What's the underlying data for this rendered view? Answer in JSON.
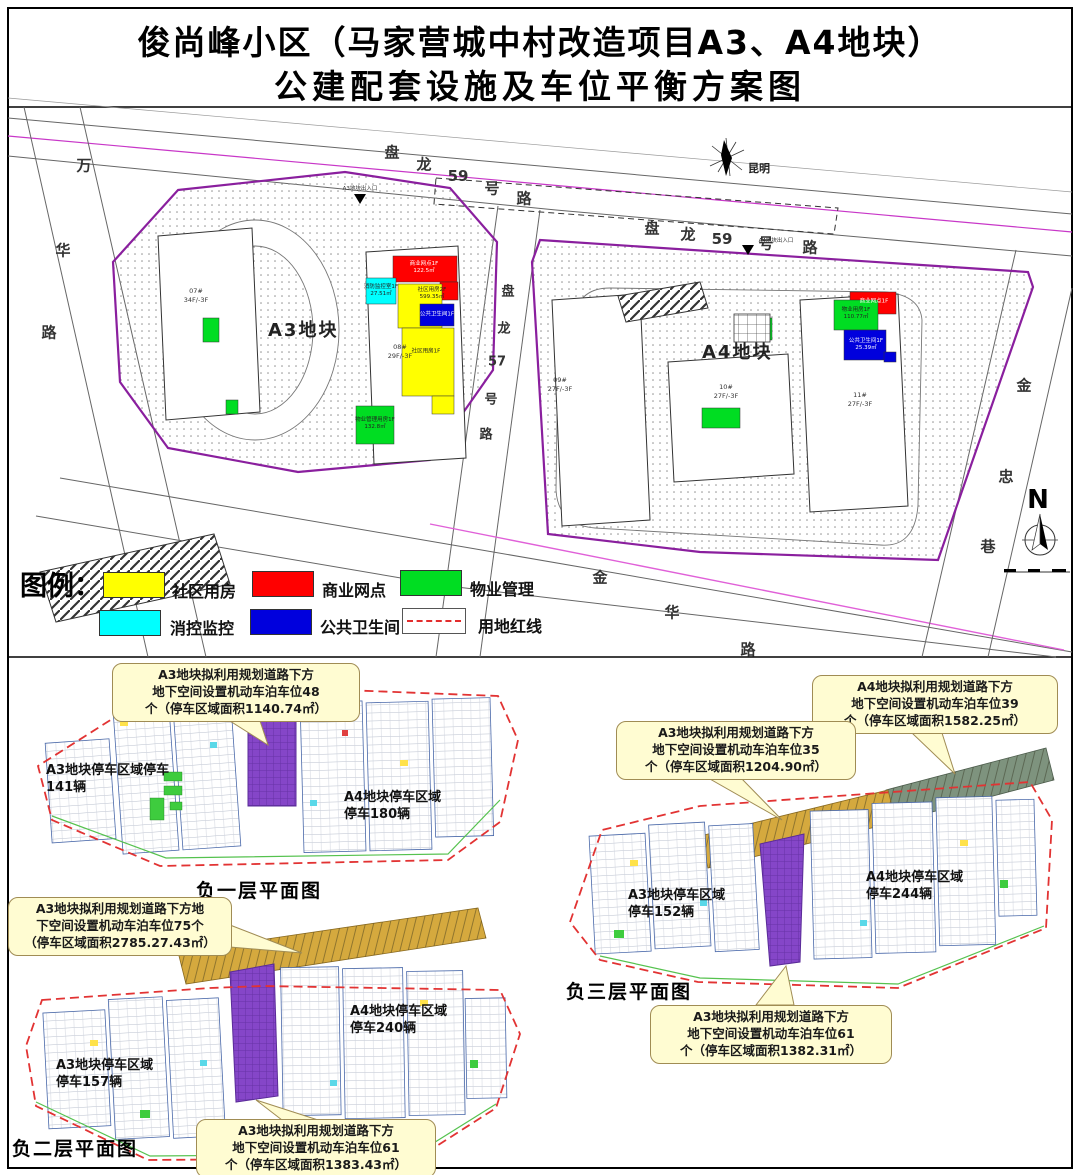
{
  "title": {
    "line1": "俊尚峰小区（马家营城中村改造项目A3、A4地块）",
    "line2": "公建配套设施及车位平衡方案图"
  },
  "site": {
    "plot_a3": "A3地块",
    "plot_a4": "A4地块",
    "city_label": "昆明",
    "north": "N",
    "roads": {
      "panlong59a": [
        "盘",
        "龙",
        "59",
        "号",
        "路"
      ],
      "panlong59b": [
        "盘",
        "龙",
        "59",
        "号",
        "路"
      ],
      "wanhua": [
        "万",
        "华",
        "路"
      ],
      "panlong57": [
        "盘",
        "龙",
        "57",
        "号",
        "路"
      ],
      "jinhua": [
        "金",
        "华",
        "路"
      ],
      "jinzhong": [
        "金",
        "忠",
        "巷"
      ]
    },
    "entrances": {
      "a3": "A3地块出入口",
      "a4": "A4地块出入口"
    },
    "buildings": {
      "b07": "07#\n34F/-3F",
      "b08": "08#\n29F/-3F",
      "b09": "09#\n27F/-3F",
      "b10": "10#\n27F/-3F",
      "b11": "11#\n27F/-3F"
    },
    "facilities": {
      "a3_shangye": "商业网点1F\n122.5㎡",
      "a3_xiaofang": "消防监控室1F\n27.51㎡",
      "a3_shequ2": "社区用房2F\n599.35㎡",
      "a3_shequ1": "社区用房1F",
      "a3_wc": "公共卫生间1F",
      "a3_wuye": "物业管理用房1F\n132.8㎡",
      "a4_wuye": "物业用房1F\n110.77㎡",
      "a4_shangye": "商业网点1F",
      "a4_wc": "公共卫生间1F\n25.39㎡"
    }
  },
  "legend": {
    "title": "图例：",
    "items": [
      {
        "label": "社区用房",
        "color": "#ffff00",
        "type": "swatch"
      },
      {
        "label": "商业网点",
        "color": "#ff0000",
        "type": "swatch"
      },
      {
        "label": "物业管理",
        "color": "#00dd22",
        "type": "swatch"
      },
      {
        "label": "消控监控",
        "color": "#00ffff",
        "type": "swatch"
      },
      {
        "label": "公共卫生间",
        "color": "#0000dd",
        "type": "swatch"
      },
      {
        "label": "用地红线",
        "color": "#e32d2d",
        "type": "dashed-line"
      }
    ]
  },
  "plans": {
    "b1": {
      "title": "负一层平面图",
      "a3_area": "A3地块停车区域停车\n141辆",
      "a4_area": "A4地块停车区域\n停车180辆",
      "callout_a3_48": "A3地块拟利用规划道路下方\n地下空间设置机动车泊车位48\n个（停车区域面积1140.74㎡）"
    },
    "b2": {
      "title": "负二层平面图",
      "a3_area": "A3地块停车区域\n停车157辆",
      "a4_area": "A4地块停车区域\n停车240辆",
      "callout_a3_75": "A3地块拟利用规划道路下方地\n下空间设置机动车泊车位75个\n（停车区域面积2785.27.43㎡）",
      "callout_a3_61": "A3地块拟利用规划道路下方\n地下空间设置机动车泊车位61\n个（停车区域面积1383.43㎡）"
    },
    "b3": {
      "title": "负三层平面图",
      "a3_area": "A3地块停车区域\n停车152辆",
      "a4_area": "A4地块停车区域\n停车244辆",
      "callout_a4_39": "A4地块拟利用规划道路下方\n地下空间设置机动车泊车位39\n个（停车区域面积1582.25㎡）",
      "callout_a3_35": "A3地块拟利用规划道路下方\n地下空间设置机动车泊车位35\n个（停车区域面积1204.90㎡）",
      "callout_a3_61": "A3地块拟利用规划道路下方\n地下空间设置机动车泊车位61\n个（停车区域面积1382.31㎡）"
    }
  },
  "colors": {
    "plot_boundary": "#8a1f9e",
    "red_line": "#e32d2d",
    "parking_ramp": "#8546c8",
    "road_band_ochre": "#d5a93e",
    "road_band_green_gray": "#7e937e",
    "callout_bg": "#fffcd2"
  }
}
